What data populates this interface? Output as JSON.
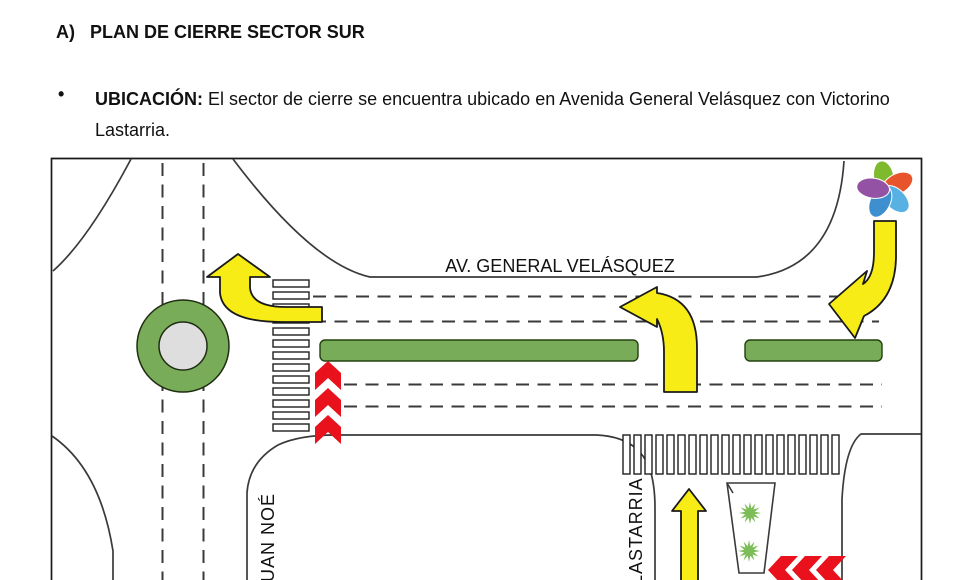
{
  "document": {
    "section_label": "A)",
    "section_title": "PLAN DE CIERRE SECTOR SUR",
    "location_bullet": {
      "marker": "•",
      "label": "UBICACIÓN:",
      "line1": "El sector de cierre se encuentra ubicado en Avenida General Velásquez con Victorino",
      "line2": "Lastarria."
    }
  },
  "diagram": {
    "street_labels": {
      "avenue": "AV. GENERAL VELÁSQUEZ",
      "left_street": "JUAN NOÉ",
      "right_street": "LASTARRIA"
    },
    "colors": {
      "road_line": "#3a3a3a",
      "median_green": "#79ac58",
      "median_stroke": "#23400f",
      "island_gray": "#dedede",
      "arrow_yellow": "#f8ec16",
      "chevron_red": "#e8111c",
      "star_green": "#7cbd57",
      "crosswalk_fill": "#ffffff"
    },
    "logo": {
      "petal_colors": [
        "#7eb92e",
        "#e8542b",
        "#57b2e3",
        "#3e8fd0",
        "#9452a5"
      ]
    }
  }
}
